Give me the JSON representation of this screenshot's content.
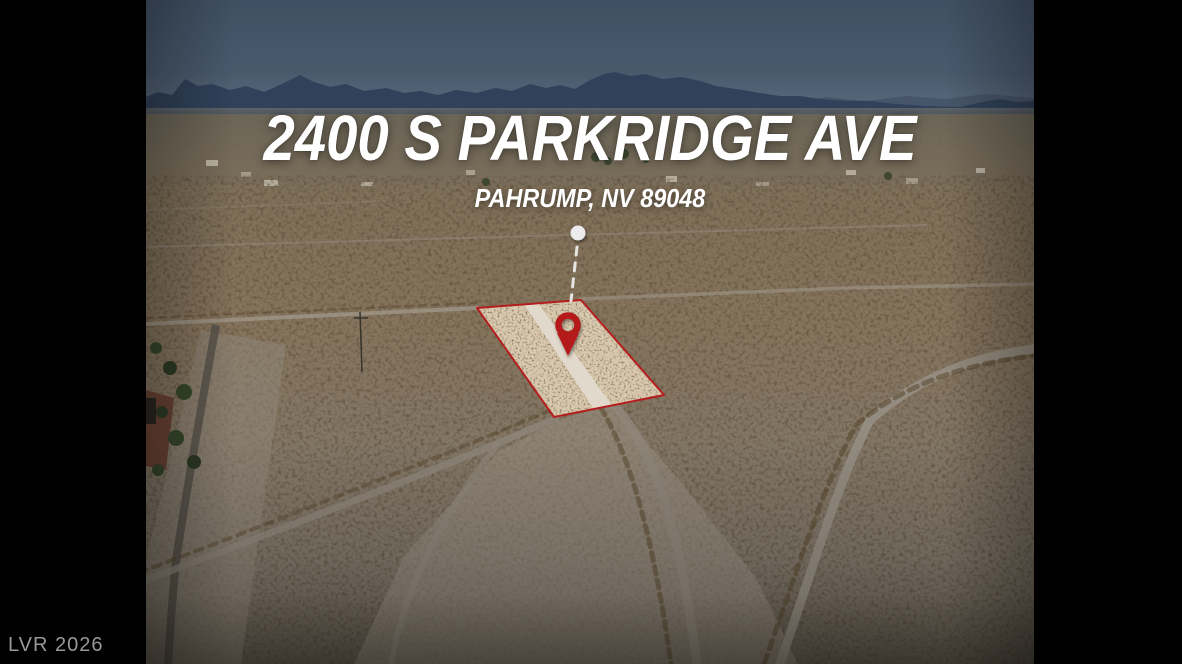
{
  "overlay": {
    "title": "2400 S PARKRIDGE AVE",
    "subtitle": "PAHRUMP, NV 89048",
    "watermark": "LVR 2026"
  },
  "colors": {
    "frame_background": "#000000",
    "accent_red": "#c32020",
    "parcel_fill": "#ead9bd",
    "parcel_road_strip": "#f3ebdc",
    "sky_top": "#44566b",
    "sky_horizon": "#66788c",
    "mountains": "#344660",
    "town_band": "#837763",
    "desert_mid": "#927f66",
    "foreground_sand": "#a59c8d",
    "dirt_road": "#9a9184",
    "title_text": "#ffffff",
    "watermark_text": "#98969a"
  },
  "icons": {
    "location_pin": "red-map-pin",
    "anchor_dot": "white-dot",
    "leader_line": "white-dashed-line"
  }
}
